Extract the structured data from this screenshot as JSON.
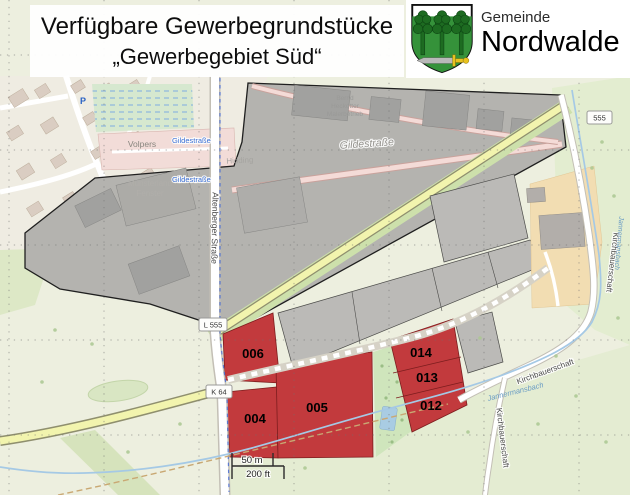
{
  "header": {
    "title_line1": "Verfügbare Gewerbegrundstücke",
    "title_line2": "„Gewerbegebiet Süd“",
    "org_label": "Gemeinde",
    "org_name": "Nordwalde",
    "crest": "nordwalde-coat-of-arms"
  },
  "scale_bar": {
    "metric": "50 m",
    "imperial": "200 ft"
  },
  "plots": {
    "available_color": "#c23a3d",
    "sold_color": "#bbbab7",
    "available": [
      {
        "id": "004"
      },
      {
        "id": "005"
      },
      {
        "id": "006"
      },
      {
        "id": "012"
      },
      {
        "id": "013"
      },
      {
        "id": "014"
      }
    ]
  },
  "signs": {
    "l555": "L 555",
    "k64": "K 64",
    "ref_555": "555"
  },
  "streets": {
    "altenberger": "Altenberger Straße",
    "gilde": "Gildestraße",
    "kirchbauerschaft": "Kirchbauerschaft"
  },
  "places": {
    "volpers": "Volpers",
    "hidding": "Hidding",
    "muensterland_1": "Münsterland",
    "muensterland_2": "Fenster",
    "business_1": "Bernd",
    "business_2": "Heckotter",
    "business_3": "Malerbetrieb",
    "parking": "P"
  },
  "water": {
    "stream": "Jannermansbach"
  }
}
